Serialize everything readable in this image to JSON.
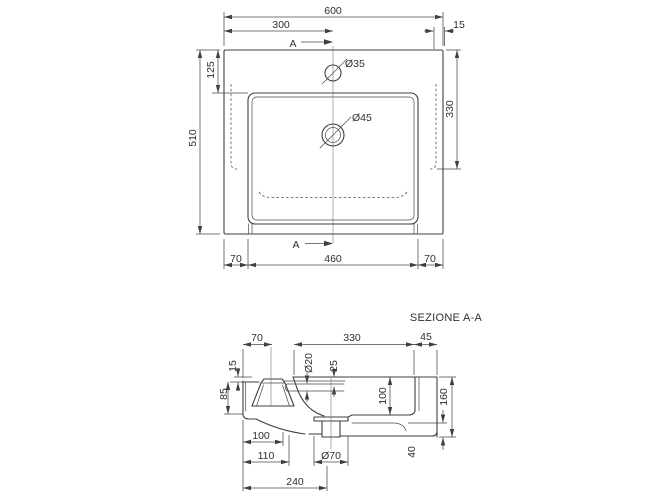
{
  "title": "SEZIONE A-A",
  "section_marker": "A",
  "colors": {
    "line": "#3f3f3f",
    "text": "#2f2f2f",
    "background": "#ffffff"
  },
  "plan": {
    "width_total": "600",
    "tap_center_from_left": "300",
    "edge_inset": "15",
    "depth_total": "510",
    "basin_back_offset": "125",
    "basin_depth_right": "330",
    "front_side_left": "70",
    "basin_width": "460",
    "front_side_right": "70",
    "tap_hole_dia": "Ø35",
    "drain_hole_dia": "Ø45"
  },
  "section": {
    "tap_center_from_back": "70",
    "basin_opening": "330",
    "front_rim": "45",
    "ledge_drop": "15",
    "ledge_height": "85",
    "overflow_dia": "Ø20",
    "overflow_offset": "25",
    "basin_inner_depth": "100",
    "height_total": "160",
    "foot_height": "40",
    "bottom_flat": "100",
    "bottom_step": "110",
    "drain_center_from_back": "240",
    "drain_flange_dia": "Ø70"
  }
}
